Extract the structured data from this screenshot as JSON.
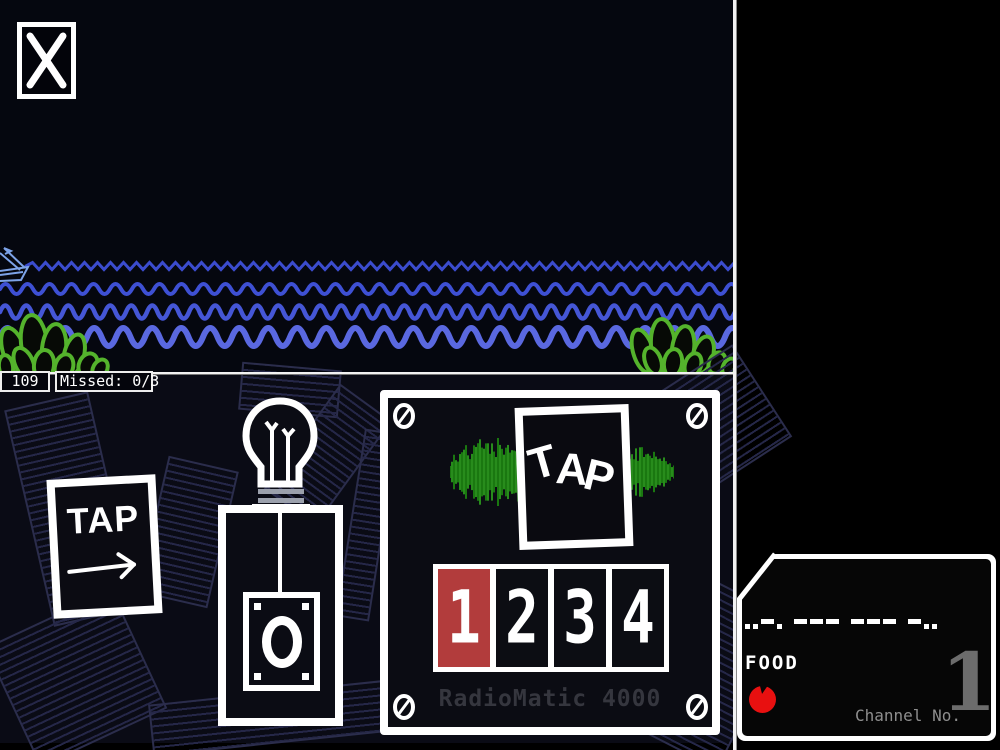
{
  "hud": {
    "score": "109",
    "missed": "Missed: 0/3"
  },
  "left_card": {
    "label": "TAP"
  },
  "radiomatic": {
    "tap_letters": {
      "t": "T",
      "a": "A",
      "p": "P"
    },
    "brand": "RadioMatic 4000",
    "buttons": [
      {
        "label": "1",
        "active": true
      },
      {
        "label": "2",
        "active": false
      },
      {
        "label": "3",
        "active": false
      },
      {
        "label": "4",
        "active": false
      }
    ]
  },
  "receiver": {
    "morse": "..-. --- --- -..",
    "decoded_word": "FOOD",
    "channel_label": "Channel No.",
    "channel_number": "1"
  },
  "colors": {
    "sky_bg": "#05070f",
    "bench_bg": "#0a0b15",
    "bush_green": "#54b32c",
    "boat_blue": "#7da3e8",
    "active_button_red": "#b23c3c",
    "tomato_red": "#e81010",
    "waveform_green": "#1e8b11",
    "brand_text": "#35363e"
  },
  "scene": {
    "waves": [
      {
        "y": 266,
        "amp": 3.5,
        "wl": 13,
        "width": 3,
        "color": "#3b4cce",
        "sharp": true,
        "x0": 26
      },
      {
        "y": 289,
        "amp": 5,
        "wl": 22,
        "width": 4,
        "color": "#3e50d4",
        "sharp": false,
        "x0": 0
      },
      {
        "y": 312,
        "amp": 6.5,
        "wl": 21,
        "width": 4.5,
        "color": "#4556d6",
        "sharp": false,
        "x0": 0
      },
      {
        "y": 337,
        "amp": 9,
        "wl": 29,
        "width": 6,
        "color": "#5a68e0",
        "sharp": false,
        "x0": 0
      }
    ],
    "waveform": {
      "width": 224,
      "height": 68,
      "base": 5,
      "envelope": [
        {
          "c": 62,
          "a": 27,
          "w": 34
        },
        {
          "c": 196,
          "a": 22,
          "w": 13
        },
        {
          "c": 18,
          "a": 10,
          "w": 12
        }
      ],
      "colors": [
        "#1e8b11",
        "#2da41e"
      ]
    }
  }
}
